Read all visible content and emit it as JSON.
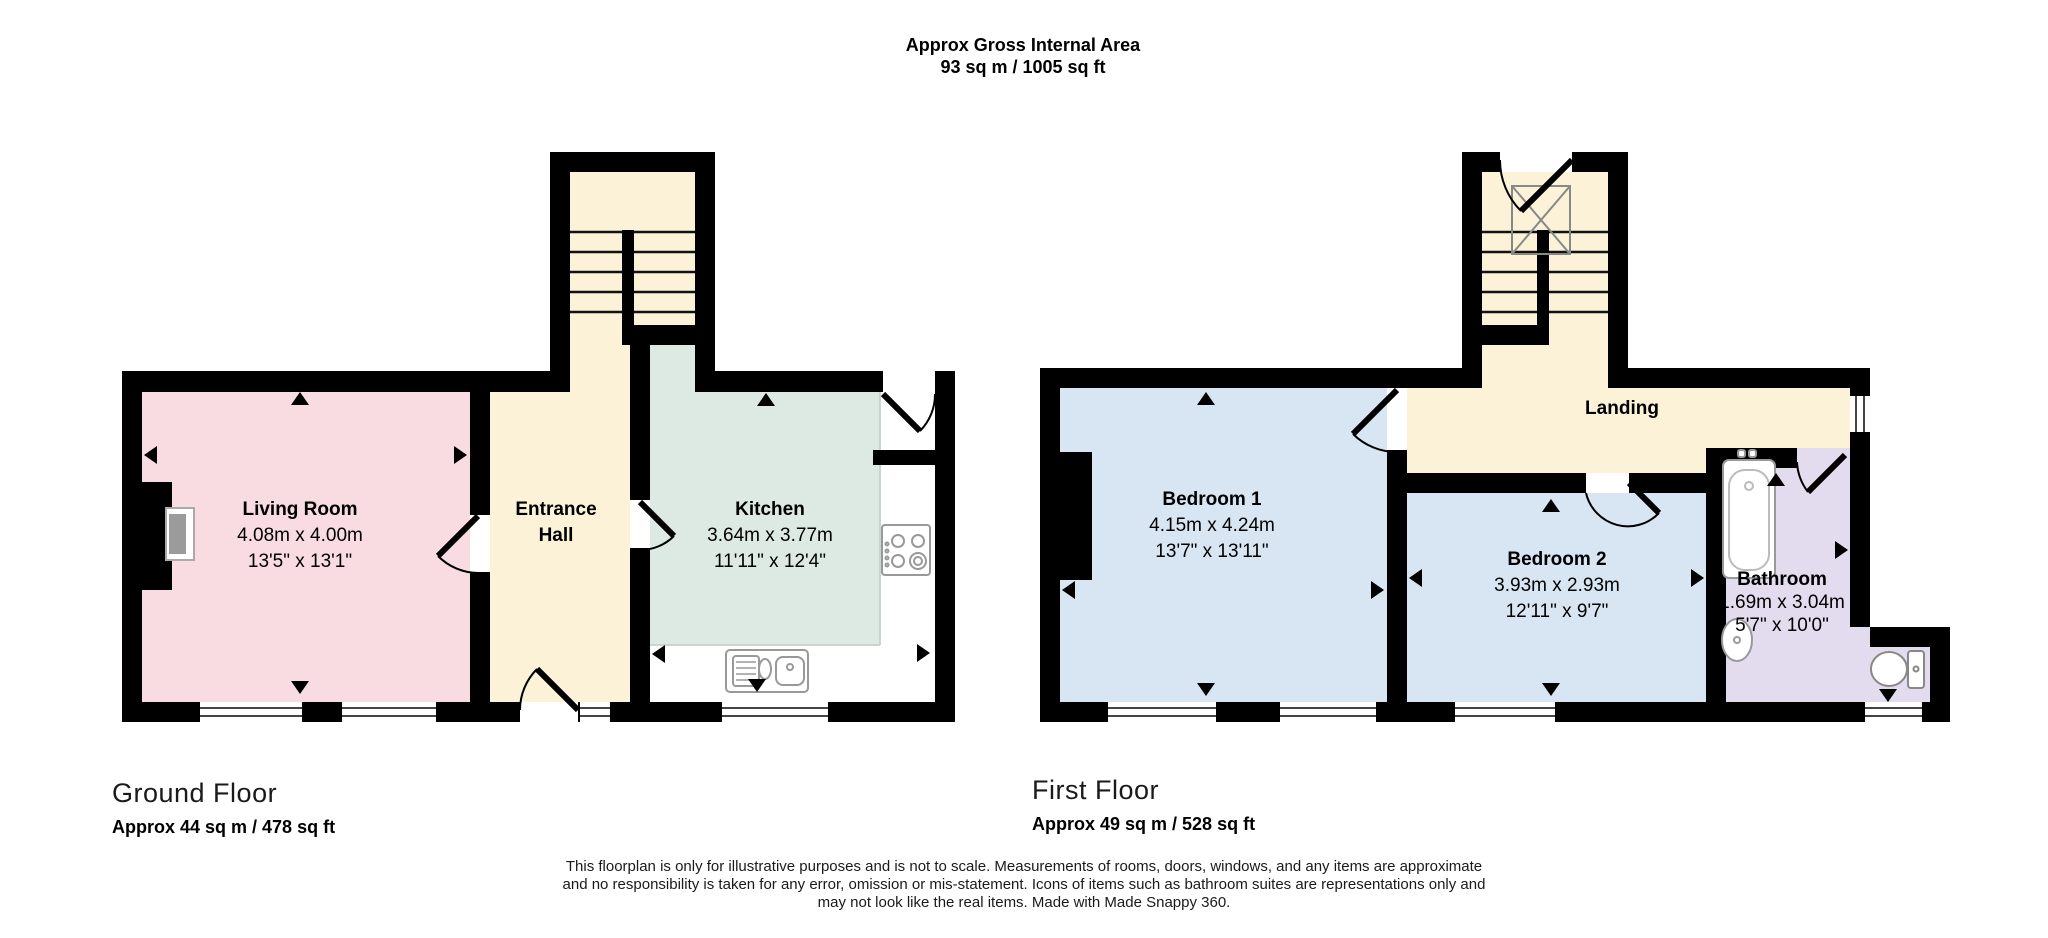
{
  "title": {
    "line1": "Approx Gross Internal Area",
    "line2": "93 sq m / 1005 sq ft"
  },
  "ground_floor": {
    "label": "Ground Floor",
    "area": "Approx 44 sq m / 478 sq ft",
    "rooms": {
      "living_room": {
        "name": "Living Room",
        "metric": "4.08m x 4.00m",
        "imperial": "13'5\" x 13'1\""
      },
      "entrance_hall": {
        "name": "Entrance Hall"
      },
      "kitchen": {
        "name": "Kitchen",
        "metric": "3.64m x 3.77m",
        "imperial": "11'11\" x 12'4\""
      }
    }
  },
  "first_floor": {
    "label": "First Floor",
    "area": "Approx 49 sq m / 528 sq ft",
    "rooms": {
      "bedroom1": {
        "name": "Bedroom 1",
        "metric": "4.15m x 4.24m",
        "imperial": "13'7\" x 13'11\""
      },
      "bedroom2": {
        "name": "Bedroom 2",
        "metric": "3.93m x 2.93m",
        "imperial": "12'11\" x 9'7\""
      },
      "bathroom": {
        "name": "Bathroom",
        "metric": "1.69m x 3.04m",
        "imperial": "5'7\" x 10'0\""
      },
      "landing": {
        "name": "Landing"
      }
    }
  },
  "disclaimer": {
    "line1": "This floorplan is only for illustrative purposes and is not to scale. Measurements of rooms, doors, windows, and any items are approximate",
    "line2": "and no responsibility is taken for any error, omission or mis-statement. Icons of items such as bathroom suites are representations only and",
    "line3": "may not look like the real items. Made with Made Snappy 360."
  },
  "colors": {
    "living_room": "#f8dce2",
    "hall_landing_stairs": "#fbf2d8",
    "kitchen": "#ddeae4",
    "bedrooms": "#d8e6f3",
    "bathroom": "#e3dbee",
    "walls": "#000000"
  },
  "icons": {
    "staircase-icon": "double flight stairs with treads",
    "loft-void-icon": "crossed box over stairwell",
    "fireplace-icon": "chimney breast with hearth",
    "sink-icon": "kitchen sink with drainer",
    "hob-icon": "four ring hob",
    "bath-icon": "bath tub with taps",
    "basin-icon": "wash basin",
    "toilet-icon": "toilet with cistern",
    "window-icon": "double line window",
    "door-icon": "door leaf with swing arc",
    "measurement-arrow-icon": "black triangle measurement pointer"
  }
}
